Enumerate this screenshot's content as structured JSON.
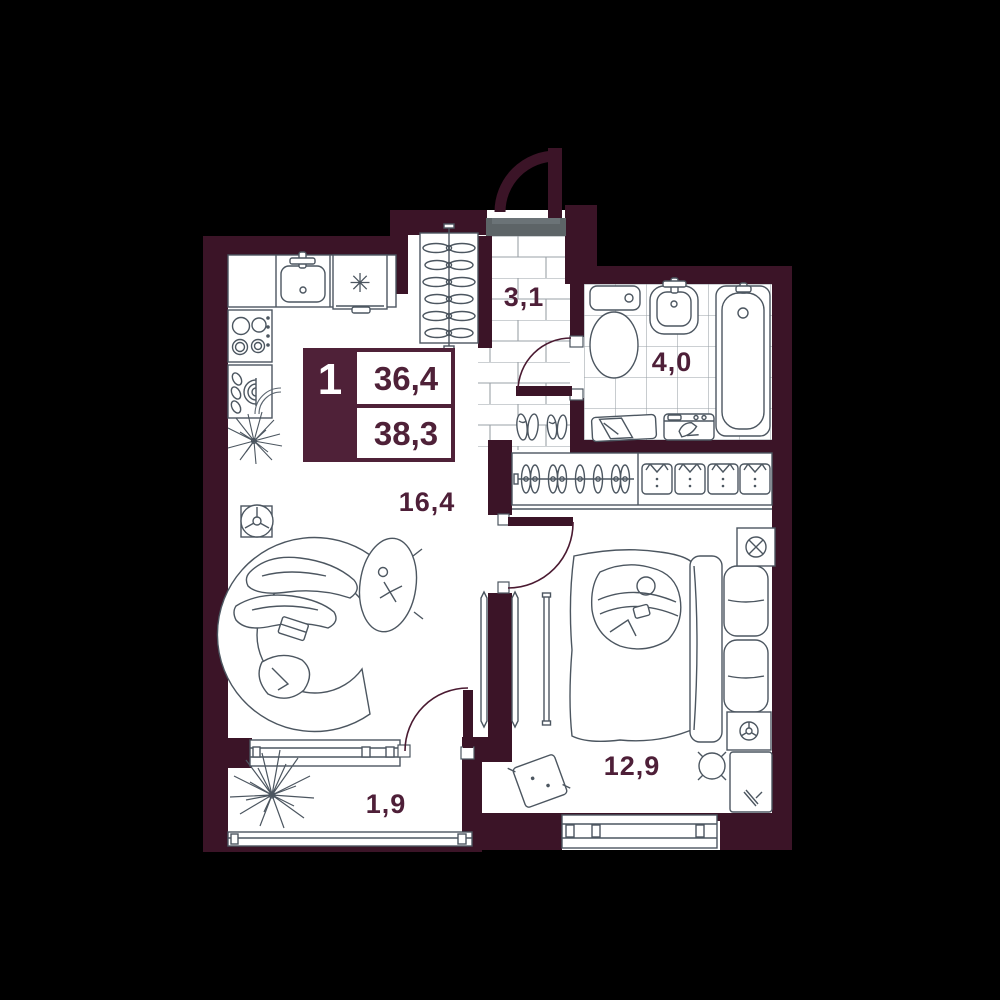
{
  "plan": {
    "legend": {
      "rooms_count": "1",
      "area_top": "36,4",
      "area_bottom": "38,3"
    },
    "rooms": [
      {
        "name": "hallway",
        "area": "3,1"
      },
      {
        "name": "bathroom",
        "area": "4,0"
      },
      {
        "name": "kitchen-living",
        "area": "16,4"
      },
      {
        "name": "bedroom",
        "area": "12,9"
      },
      {
        "name": "balcony",
        "area": "1,9"
      }
    ],
    "kitchen": {
      "freezer_symbol": "✳"
    },
    "colors": {
      "background": "#000000",
      "wall": "#3b1427",
      "floor": "#ffffff",
      "furniture_line": "#4c5660",
      "label_text": "#4e1f38",
      "legend_box": "#4f2138",
      "threshold": "#5d6467",
      "tile_line": "#9aa1a7"
    }
  }
}
